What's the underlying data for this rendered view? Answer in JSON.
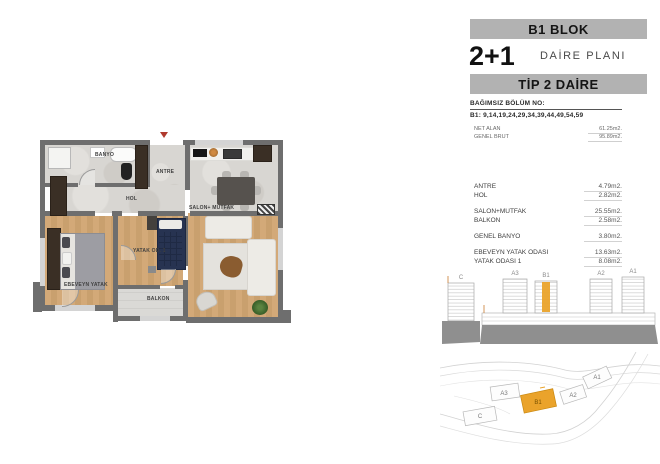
{
  "header": {
    "block_title": "B1 BLOK",
    "unit_type": "2+1",
    "plan_label": "DAİRE PLANI",
    "tip_label": "TİP 2 DAİRE",
    "section_no_label": "BAĞIMSIZ BÖLÜM NO:",
    "section_no_value": "B1: 9,14,19,24,29,34,39,44,49,54,59"
  },
  "summary": {
    "net_label": "NET ALAN",
    "net_value": "61.25m2.",
    "brut_label": "GENEL BRUT",
    "brut_value": "95.89m2."
  },
  "areas": {
    "groups": [
      {
        "rows": [
          {
            "label": "ANTRE",
            "value": "4.79m2."
          },
          {
            "label": "HOL",
            "value": "2.82m2."
          }
        ]
      },
      {
        "rows": [
          {
            "label": "SALON+MUTFAK",
            "value": "25.55m2."
          },
          {
            "label": "BALKON",
            "value": "2.58m2."
          }
        ]
      },
      {
        "rows": [
          {
            "label": "GENEL BANYO",
            "value": "3.80m2."
          }
        ]
      },
      {
        "rows": [
          {
            "label": "EBEVEYN YATAK ODASI",
            "value": "13.63m2."
          },
          {
            "label": "YATAK ODASI 1",
            "value": "8.08m2."
          }
        ]
      }
    ]
  },
  "floorplan": {
    "labels": {
      "banyo": "BANYO",
      "antre": "ANTRE",
      "hol": "HOL",
      "salon": "SALON+ MUTFAK",
      "yatak1": "YATAK OD. 1",
      "ebeveyn": "EBEVEYN YATAK",
      "balkon": "BALKON"
    }
  },
  "elevation": {
    "labels": {
      "c": "C",
      "a3": "A3",
      "b1": "B1",
      "a2": "A2",
      "a1": "A1"
    },
    "highlighted_block": "B1"
  },
  "siteplan": {
    "labels": {
      "c": "C",
      "a3": "A3",
      "b1": "B1",
      "a2": "A2",
      "a1": "A1"
    },
    "highlighted_block": "B1"
  },
  "colors": {
    "highlight_orange": "#EAA32B",
    "header_bar_gray": "#B2B2B2",
    "wall_gray": "#6E6E6E",
    "wood_floor": "#CFA674"
  }
}
